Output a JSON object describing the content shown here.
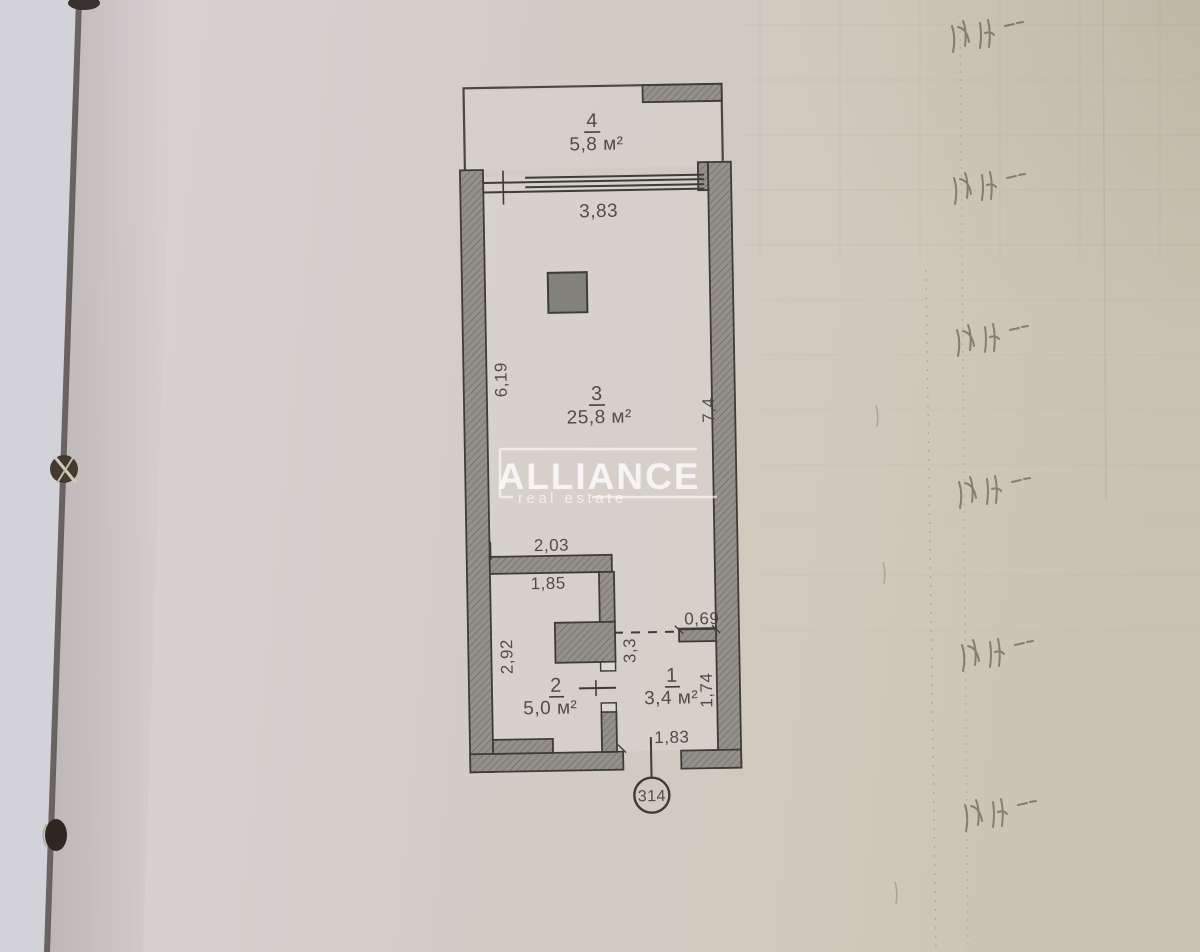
{
  "watermark": {
    "brand": "ALLIANCE",
    "tagline": "real estate"
  },
  "plan": {
    "unit_label": "314",
    "rooms": [
      {
        "number": "4",
        "area": "5,8 м²"
      },
      {
        "number": "3",
        "area": "25,8 м²"
      },
      {
        "number": "2",
        "area": "5,0 м²"
      },
      {
        "number": "1",
        "area": "3,4 м²"
      }
    ],
    "dimensions": {
      "window_width": "3,83",
      "room3_left": "6,19",
      "room3_right": "7,4",
      "partition_width": "2,03",
      "partition_inner": "1,85",
      "hall_opening": "0,69",
      "room2_left": "2,92",
      "hall_height": "3,3",
      "room1_right": "1,74",
      "entry_width": "1,83"
    },
    "colors": {
      "wall_fill": "#94918c",
      "line": "#3e3c39",
      "paper": "#d2cbc4"
    }
  }
}
